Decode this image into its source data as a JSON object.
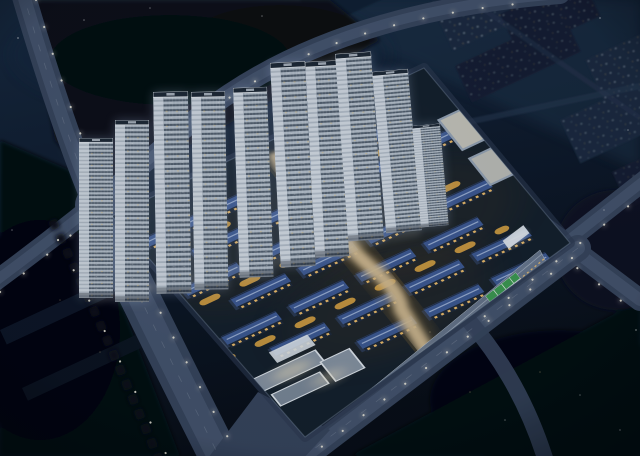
{
  "scene": {
    "type": "architectural-night-aerial-rendering",
    "subject": "Master-planned residential development at night, oblique aerial view",
    "time_of_day": "night",
    "visible_text": "none",
    "features": [
      "row of white high-rise towers along the northwest edge of the site",
      "grid of low-rise homes with blue pitched roofs and amber lit windows",
      "amber-lit autumn trees between the housing rows",
      "warm-lit central pedestrian axis crossing the site",
      "retail strips along the northeast and southeast edges",
      "community courtyard cluster near the south corner",
      "green-roofed pavilion near the east corner",
      "two road intersections with traffic light-trails",
      "dark background city blocks with scattered lit windows",
      "streetlight dots lining all roads and dark tree masses at the image edges"
    ],
    "counts": {
      "high_rise_towers": 10,
      "townhouse_rows": 7,
      "townhouse_blocks": 27,
      "light_trail_intersections": 2
    }
  },
  "palette": {
    "bg_top": "#17293f",
    "bg_mid": "#0f1b2d",
    "bg_deep": "#070c14",
    "haze": "#223850",
    "road": "#39465e",
    "road_light": "#4d5c75",
    "road_lane": "#c9d2de",
    "curb": "#93a4ba",
    "bg_block": "#1a2940",
    "bg_block_2": "#141f33",
    "window_dot": "#cfe0f2",
    "warm_dot": "#e9c474",
    "tower_face": "#b7c1cc",
    "tower_side": "#d8dfe7",
    "tower_win": "#59636f",
    "tower_roof": "#1f2835",
    "tower_trim": "#eef2f6",
    "roof_blue": "#3f5b95",
    "roof_hi": "#9db1d6",
    "facade_dark": "#1e2838",
    "window_amber": "#ffc96e",
    "tree_amber": "#c08030",
    "tree_amber_2": "#e2a843",
    "tree_green": "#223220",
    "tree_dark": "#05080e",
    "ground": "#15202b",
    "path_warm": "#d9c094",
    "strip_roof": "#6f7d92",
    "strip_lit": "#f6e7c2",
    "white_bldg": "#e6ecf2",
    "green_roof": "#3f9e52",
    "trail_pink": "#ef8cc0",
    "trail_violet": "#a18ae4",
    "trail_white": "#f6f4fc",
    "street_dot": "#f6f2e2"
  }
}
